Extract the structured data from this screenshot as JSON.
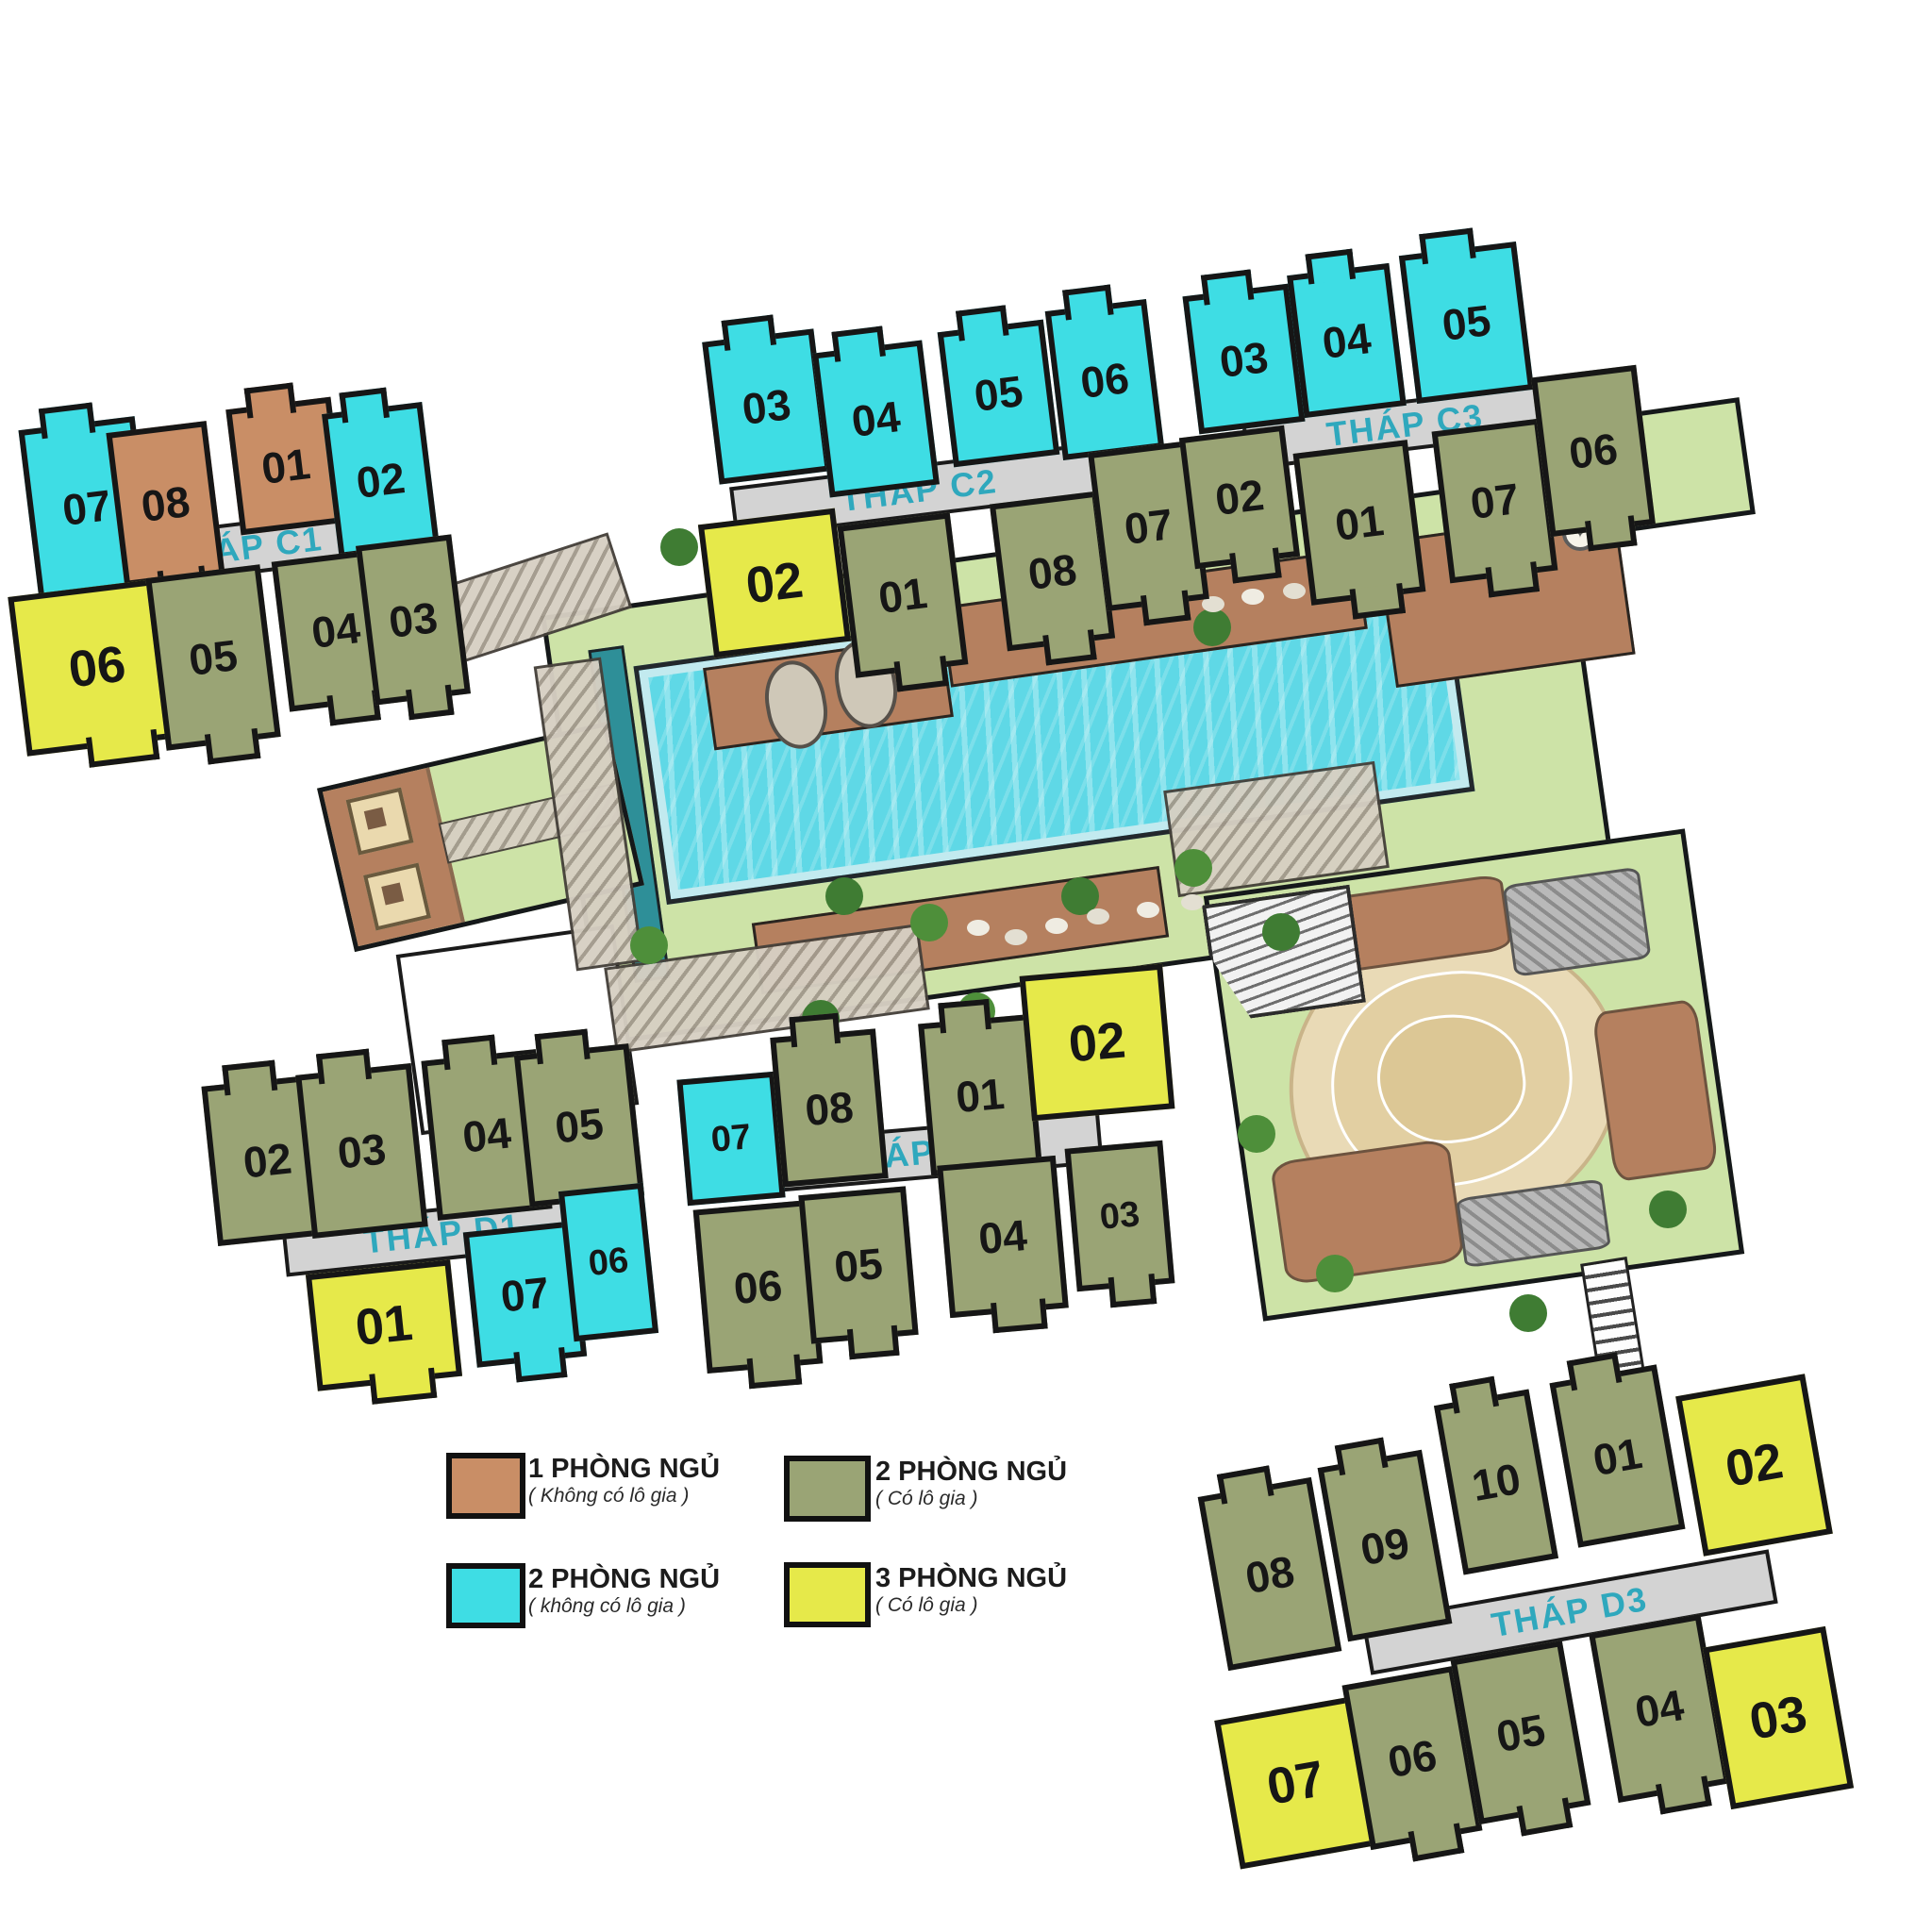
{
  "title": "Mặt bằng tháp C1 C2 C3 D1 D2 D3",
  "colors": {
    "unit_1br_no_loggia": "#c98e66",
    "unit_2br_no_loggia": "#3edde4",
    "unit_2br_loggia": "#9aa475",
    "unit_3br_loggia": "#e6e94a",
    "tower_label_text": "#2fa8bd",
    "tower_base_strip": "#d3d3d3",
    "outline": "#161616",
    "pool_water": "#5fd8e6",
    "lap_pool": "#2e8f98",
    "garden": "#cde3a7",
    "wood_deck": "#b5805f",
    "sand": "#e9dab6"
  },
  "towers": {
    "C1": {
      "label": "THÁP C1",
      "units": [
        {
          "no": "07",
          "type": "2pn-khong-lo-gia"
        },
        {
          "no": "08",
          "type": "1pn-khong-lo-gia"
        },
        {
          "no": "01",
          "type": "1pn-khong-lo-gia"
        },
        {
          "no": "02",
          "type": "2pn-khong-lo-gia"
        },
        {
          "no": "06",
          "type": "3pn-co-lo-gia"
        },
        {
          "no": "05",
          "type": "2pn-co-lo-gia"
        },
        {
          "no": "04",
          "type": "2pn-co-lo-gia"
        },
        {
          "no": "03",
          "type": "2pn-co-lo-gia"
        }
      ]
    },
    "C2": {
      "label": "THÁP C2",
      "units": [
        {
          "no": "03",
          "type": "2pn-khong-lo-gia"
        },
        {
          "no": "04",
          "type": "2pn-khong-lo-gia"
        },
        {
          "no": "05",
          "type": "2pn-khong-lo-gia"
        },
        {
          "no": "06",
          "type": "2pn-khong-lo-gia"
        },
        {
          "no": "02",
          "type": "3pn-co-lo-gia"
        },
        {
          "no": "01",
          "type": "2pn-co-lo-gia"
        },
        {
          "no": "08",
          "type": "2pn-co-lo-gia"
        },
        {
          "no": "07",
          "type": "2pn-co-lo-gia"
        }
      ]
    },
    "C3": {
      "label": "THÁP C3",
      "units": [
        {
          "no": "03",
          "type": "2pn-khong-lo-gia"
        },
        {
          "no": "04",
          "type": "2pn-khong-lo-gia"
        },
        {
          "no": "05",
          "type": "2pn-khong-lo-gia"
        },
        {
          "no": "02",
          "type": "2pn-co-lo-gia"
        },
        {
          "no": "01",
          "type": "2pn-co-lo-gia"
        },
        {
          "no": "07",
          "type": "2pn-co-lo-gia"
        },
        {
          "no": "06",
          "type": "2pn-co-lo-gia"
        }
      ]
    },
    "D1": {
      "label": "THÁP D1",
      "units": [
        {
          "no": "02",
          "type": "2pn-co-lo-gia"
        },
        {
          "no": "03",
          "type": "2pn-co-lo-gia"
        },
        {
          "no": "04",
          "type": "2pn-co-lo-gia"
        },
        {
          "no": "05",
          "type": "2pn-co-lo-gia"
        },
        {
          "no": "01",
          "type": "3pn-co-lo-gia"
        },
        {
          "no": "07",
          "type": "2pn-khong-lo-gia"
        },
        {
          "no": "06",
          "type": "2pn-khong-lo-gia"
        }
      ]
    },
    "D2": {
      "label": "THÁP D2",
      "units": [
        {
          "no": "07",
          "type": "2pn-khong-lo-gia"
        },
        {
          "no": "08",
          "type": "2pn-co-lo-gia"
        },
        {
          "no": "01",
          "type": "2pn-co-lo-gia"
        },
        {
          "no": "02",
          "type": "3pn-co-lo-gia"
        },
        {
          "no": "06",
          "type": "2pn-co-lo-gia"
        },
        {
          "no": "05",
          "type": "2pn-co-lo-gia"
        },
        {
          "no": "04",
          "type": "2pn-co-lo-gia"
        },
        {
          "no": "03",
          "type": "2pn-co-lo-gia"
        }
      ]
    },
    "D3": {
      "label": "THÁP D3",
      "units": [
        {
          "no": "08",
          "type": "2pn-co-lo-gia"
        },
        {
          "no": "09",
          "type": "2pn-co-lo-gia"
        },
        {
          "no": "10",
          "type": "2pn-co-lo-gia"
        },
        {
          "no": "01",
          "type": "2pn-co-lo-gia"
        },
        {
          "no": "02",
          "type": "3pn-co-lo-gia"
        },
        {
          "no": "07",
          "type": "3pn-co-lo-gia"
        },
        {
          "no": "06",
          "type": "2pn-co-lo-gia"
        },
        {
          "no": "05",
          "type": "2pn-co-lo-gia"
        },
        {
          "no": "04",
          "type": "2pn-co-lo-gia"
        },
        {
          "no": "03",
          "type": "3pn-co-lo-gia"
        }
      ]
    }
  },
  "legend": {
    "items": [
      {
        "swatch": "#c98e66",
        "title": "1 PHÒNG NGỦ",
        "subtitle": "( Không có lô gia )"
      },
      {
        "swatch": "#9aa475",
        "title": "2 PHÒNG NGỦ",
        "subtitle": "( Có lô gia )"
      },
      {
        "swatch": "#3edde4",
        "title": "2 PHÒNG NGỦ",
        "subtitle": "( không  có lô gia )"
      },
      {
        "swatch": "#e6e94a",
        "title": "3 PHÒNG NGỦ",
        "subtitle": "( Có lô gia )"
      }
    ]
  }
}
